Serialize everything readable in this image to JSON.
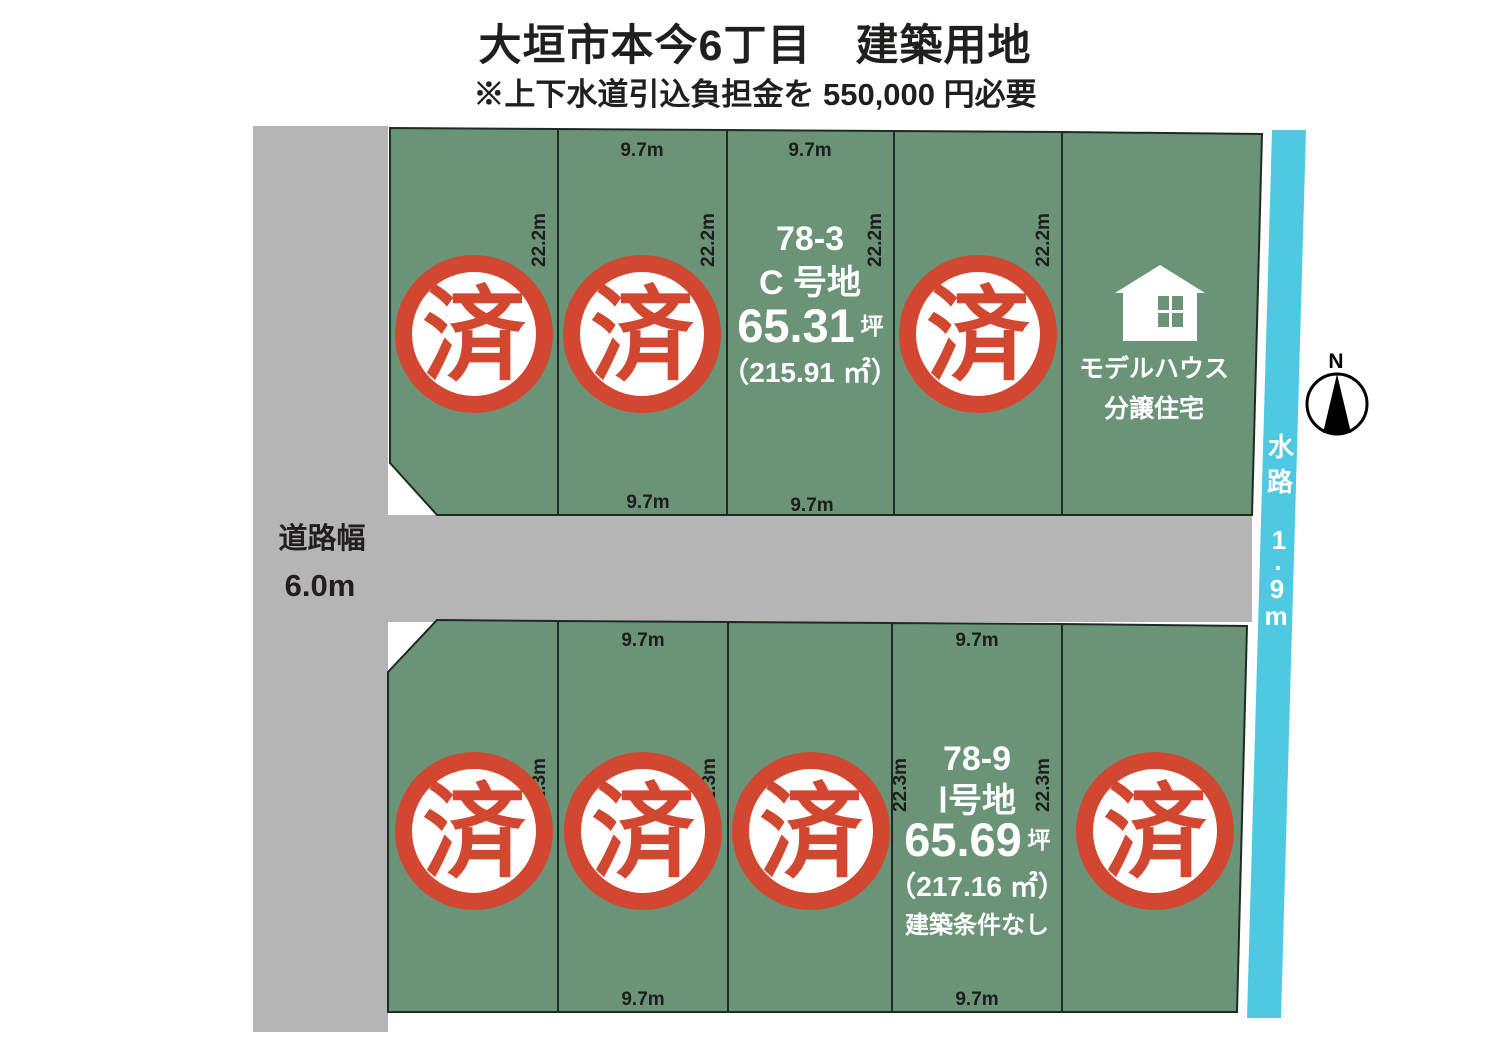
{
  "header": {
    "title": "大垣市本今6丁目　建築用地",
    "subtitle": "※上下水道引込負担金を 550,000 円必要"
  },
  "road": {
    "label_line1": "道路幅",
    "label_line2": "6.0m"
  },
  "waterway": {
    "chars": [
      "水",
      "路",
      "1",
      ".",
      "9",
      "m"
    ]
  },
  "compass": {
    "north_label": "N"
  },
  "dims": {
    "frontage": "9.7m",
    "depth_top_row": "22.2m",
    "depth_bottom_row": "22.3m"
  },
  "sold_stamp": "済",
  "lots": {
    "c": {
      "number": "78-3",
      "name": "C 号地",
      "tsubo": "65.31",
      "tsubo_unit": "坪",
      "area": "（215.91 ㎡）"
    },
    "i": {
      "number": "78-9",
      "name": "Ⅰ号地",
      "tsubo": "65.69",
      "tsubo_unit": "坪",
      "area": "（217.16 ㎡）",
      "note": "建築条件なし"
    },
    "model_house": {
      "line1": "モデルハウス",
      "line2": "分譲住宅"
    }
  },
  "colors": {
    "plot_green": "#6a9377",
    "road_gray": "#b5b5b5",
    "water_cyan": "#4fc9e1",
    "stamp_red": "#d2472f",
    "ink": "#1d1d1b"
  }
}
